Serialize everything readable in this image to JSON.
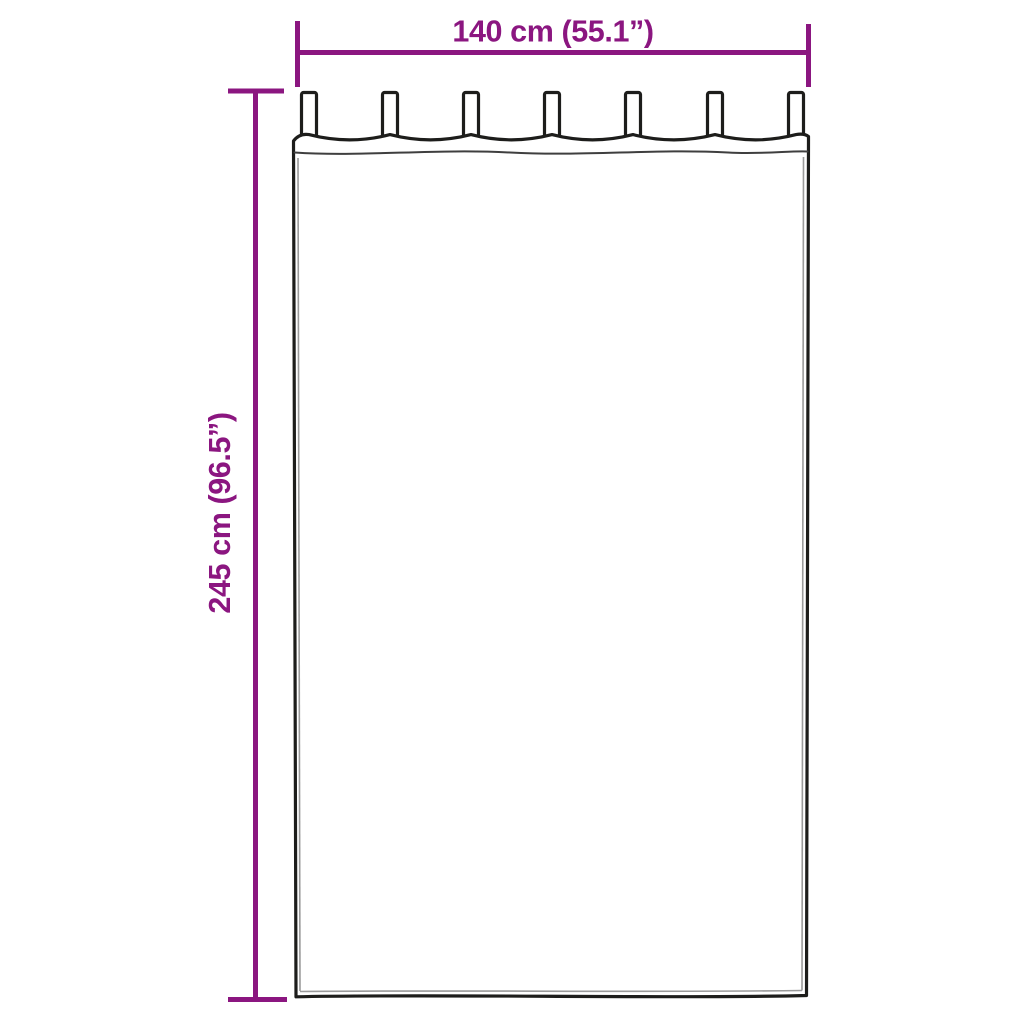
{
  "diagram": {
    "type": "curtain-dimension-diagram",
    "width_label": "140 cm (55.1”)",
    "height_label": "245 cm (96.5”)",
    "tab_count": 7
  },
  "colors": {
    "accent": "#8b1680",
    "outline": "#1d1d1b",
    "seam": "#3f3f3f",
    "hem": "#9a9a9a"
  }
}
